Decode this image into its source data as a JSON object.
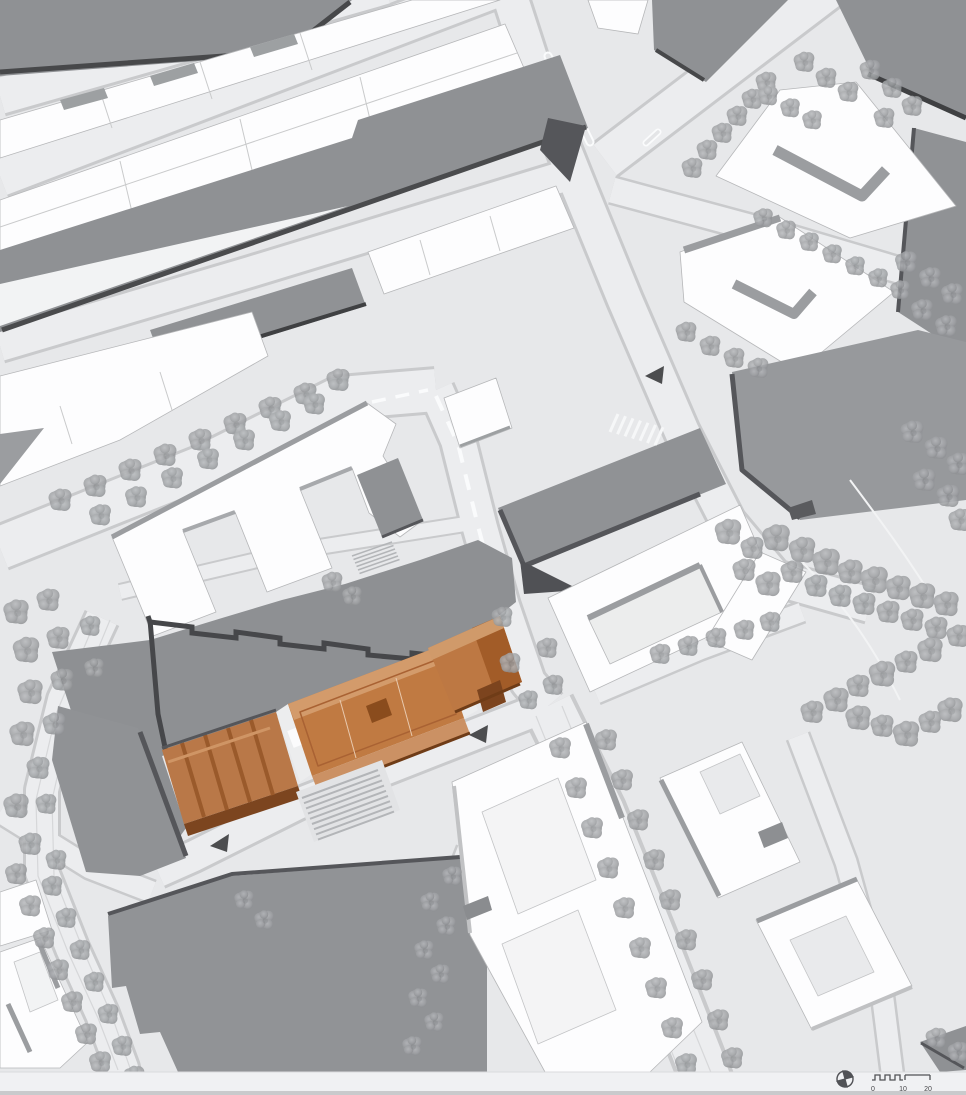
{
  "plan": {
    "kind": "architectural site plan",
    "view": "aerial axonometric roof plan",
    "highlighted_feature": "new-building-complex"
  },
  "scale_bar": {
    "tick_labels": [
      "0",
      "10",
      "20"
    ]
  },
  "colors": {
    "background": "#e7e8ea",
    "street": "#ecedef",
    "street_edge": "#c9cacc",
    "white_building": "#fdfdfe",
    "gray_building": "#909295",
    "shadow_edge": "#47484a",
    "plaza": "#8e9093",
    "tree": "#9fa1a4",
    "highlight": "#c07a42",
    "highlight_dark": "#8a4c1d",
    "highlight_light": "#d39b6b"
  }
}
